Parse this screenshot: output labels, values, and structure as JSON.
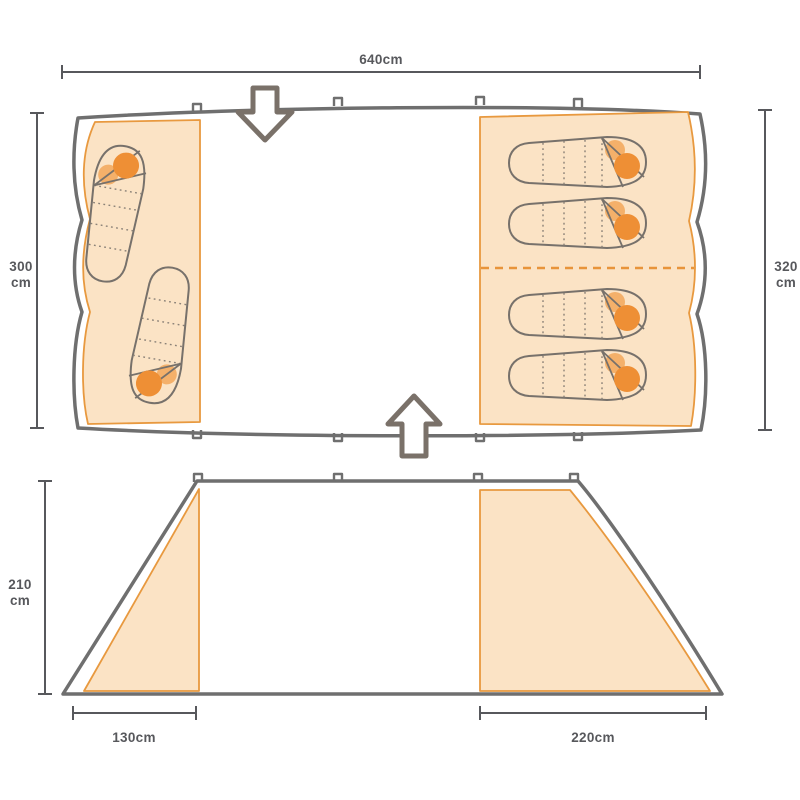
{
  "diagram": {
    "type": "tent-dimensions-diagram",
    "colors": {
      "canvas": "#ffffff",
      "fabric_fill": "#FBE3C5",
      "fabric_stroke": "#E8993F",
      "tent_outline": "#6F6F6F",
      "bag_outline": "#77716B",
      "person_head": "#EE8F35",
      "person_body": "#F4B06A",
      "dimension_text": "#57585C",
      "door_arrow": "#7A7169"
    },
    "top_view": {
      "width_dim": "640cm",
      "left_depth_value": "300",
      "left_depth_unit": "cm",
      "right_depth_value": "320",
      "right_depth_unit": "cm",
      "left_bedroom_bags": 2,
      "right_bedroom_bags": 4,
      "doors": [
        "front-door-top",
        "rear-door-bottom"
      ]
    },
    "side_view": {
      "height_value": "210",
      "height_unit": "cm",
      "left_section_dim": "130cm",
      "right_section_dim": "220cm"
    }
  }
}
